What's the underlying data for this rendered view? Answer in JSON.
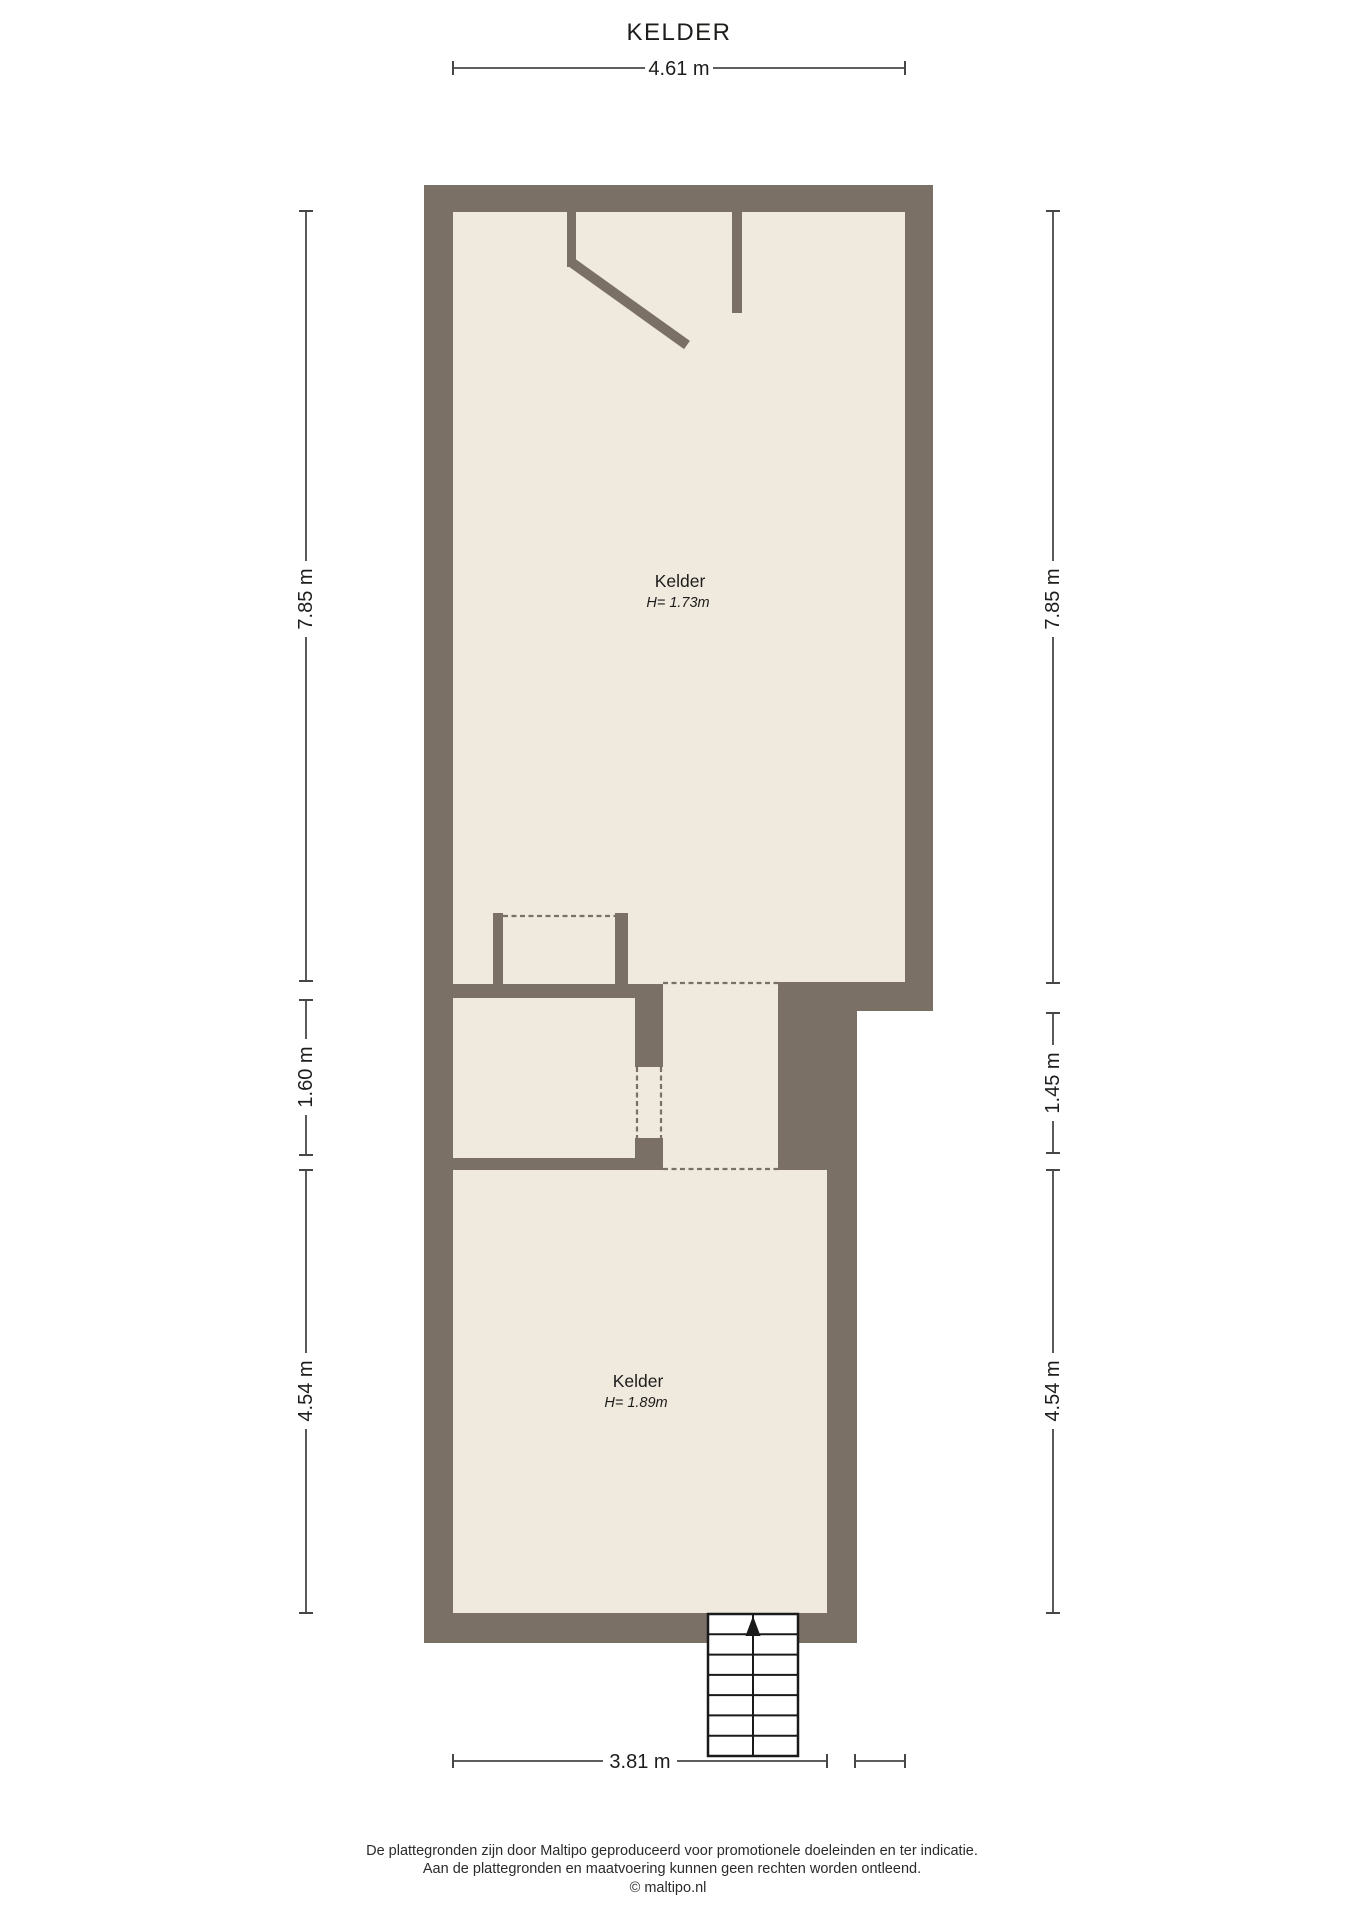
{
  "plan": {
    "title": "KELDER"
  },
  "colors": {
    "wall": "#7a7066",
    "floor": "#f0e9de",
    "background": "#ffffff",
    "dimension_line": "#474747",
    "text": "#1d1d1b",
    "stairs_border": "#1a1a1a",
    "stairs_fill": "#ffffff"
  },
  "rooms": [
    {
      "name": "Kelder",
      "height": "H= 1.73m"
    },
    {
      "name": "Kelder",
      "height": "H= 1.89m"
    }
  ],
  "dimensions": {
    "top": "4.61 m",
    "bottom": "3.81 m",
    "left": [
      "7.85 m",
      "1.60 m",
      "4.54 m"
    ],
    "right": [
      "7.85 m",
      "1.45 m",
      "4.54 m"
    ]
  },
  "footer": {
    "line1": "De plattegronden zijn door Maltipo geproduceerd voor promotionele doeleinden en ter indicatie.",
    "line2": "Aan de plattegronden en maatvoering kunnen geen rechten worden ontleend.",
    "line3": "© maltipo.nl"
  }
}
